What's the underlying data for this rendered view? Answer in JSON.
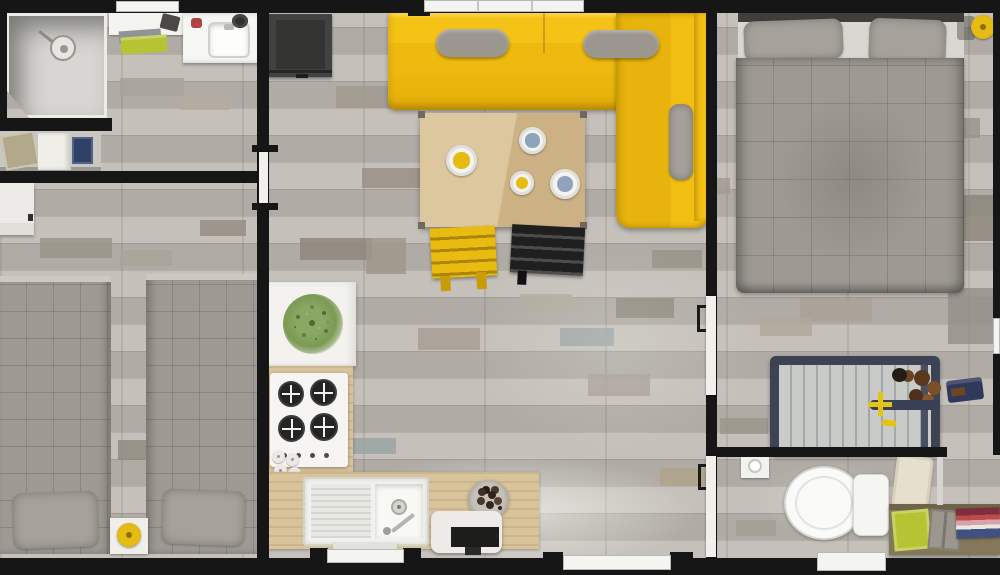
{
  "meta": {
    "kind": "floor-plan-top-down-render",
    "description": "photorealistic top view floor plan of a mobile-home style unit with weathered gray plank flooring"
  },
  "palette": {
    "wall": "#161616",
    "plank_light": "#c5c1ba",
    "plank_dark": "#b0aca5",
    "white_surface": "#f4f4f1",
    "sofa_yellow": "#efbc11",
    "sofa_deep": "#dfa90a",
    "cushion_gray": "#9c978e",
    "table_wood": "#dcc79f",
    "counter_wood": "#d9c39b",
    "chair_yellow": "#e9ba10",
    "chair_black": "#1f1f1f",
    "bed_gray": "#9e9a93",
    "pillow_gray": "#a6a29b",
    "tub_frame": "#3e4353",
    "tub_inner": "#c9cbc9",
    "plant_green": "#7d9a54",
    "towel_green": "#b6c433",
    "towel_navy": "#2f4166",
    "towel_khaki": "#b2a88a",
    "lamp_yellow": "#e6bb12",
    "shelf_wood": "#84785b",
    "fridge_dark": "#424240",
    "accent_red": "#b04343",
    "cup_blue": "#8fa3bb"
  },
  "rooms": {
    "bathroom_top_left": {
      "items": [
        "corner-shower",
        "shower-head",
        "top-window",
        "shelf-with-toiletry-bag",
        "green-floor-towel",
        "vanity-with-sink",
        "towel-rack"
      ],
      "rack_towels": [
        "khaki-towel",
        "white-towel",
        "navy-towel"
      ]
    },
    "bedroom_left": {
      "items": [
        "white-wardrobe",
        "twin-bed-left",
        "twin-bed-right",
        "gray-pillows",
        "nightstand",
        "yellow-lamp"
      ]
    },
    "living_kitchen_center": {
      "items": [
        "tall-dark-cabinet",
        "yellow-corner-sofa",
        "gray-seat-cushions",
        "gray-lumbar-pillow",
        "dining-table",
        "teapot",
        "blue-mugs",
        "yellow-mug",
        "yellow-slat-chair",
        "black-slat-chair",
        "white-plant-table",
        "potted-plant",
        "gas-hob",
        "hob-knobs",
        "salt-pepper-set",
        "l-shaped-counter",
        "sink-with-drainboard",
        "faucet",
        "fruit-bowl",
        "coffee-machine",
        "top-window",
        "bottom-window",
        "patio-window"
      ]
    },
    "bedroom_right": {
      "items": [
        "double-bed",
        "gray-quilted-comforter",
        "gray-pillows",
        "yellow-lamp",
        "bathtub",
        "bath-caddy-baskets",
        "yellow-handle-faucet",
        "clothes-pile"
      ]
    },
    "bathroom_bottom_right": {
      "items": [
        "toilet",
        "toilet-paper-holder",
        "bath-mat",
        "wood-towel-shelf",
        "green-folded-towel",
        "gray-toiletry-bag",
        "stacked-towels",
        "bottom-door"
      ]
    }
  },
  "floor_patches": [
    [
      120,
      78,
      64,
      18,
      "#a8a29a"
    ],
    [
      180,
      96,
      50,
      14,
      "#b4aca0"
    ],
    [
      336,
      86,
      72,
      22,
      "#a19a90"
    ],
    [
      438,
      66,
      54,
      16,
      "#b2a58d"
    ],
    [
      300,
      238,
      72,
      22,
      "#8e867c"
    ],
    [
      362,
      168,
      62,
      20,
      "#999187"
    ],
    [
      520,
      294,
      52,
      18,
      "#b2aa9e"
    ],
    [
      560,
      328,
      54,
      18,
      "#9aa3a4"
    ],
    [
      616,
      298,
      58,
      20,
      "#8f887e"
    ],
    [
      652,
      250,
      50,
      18,
      "#9a9288"
    ],
    [
      688,
      178,
      42,
      16,
      "#a39b90"
    ],
    [
      588,
      374,
      62,
      22,
      "#a8a096"
    ],
    [
      418,
      328,
      62,
      22,
      "#a79f94"
    ],
    [
      350,
      438,
      46,
      16,
      "#9aa3a4"
    ],
    [
      660,
      468,
      52,
      18,
      "#afa28a"
    ],
    [
      800,
      298,
      72,
      24,
      "#a9a196"
    ],
    [
      918,
      118,
      62,
      20,
      "#9a948a"
    ],
    [
      955,
      195,
      45,
      46,
      "#8d877d"
    ],
    [
      760,
      318,
      52,
      18,
      "#b0a89c"
    ],
    [
      720,
      418,
      48,
      16,
      "#9c968c"
    ],
    [
      948,
      288,
      48,
      56,
      "#95908a"
    ],
    [
      40,
      238,
      72,
      20,
      "#9a948a"
    ],
    [
      120,
      250,
      52,
      16,
      "#aaa399"
    ],
    [
      30,
      200,
      40,
      14,
      "#b2aca2"
    ],
    [
      200,
      220,
      46,
      16,
      "#948e84"
    ],
    [
      118,
      440,
      36,
      20,
      "#8f8a80"
    ],
    [
      238,
      300,
      24,
      40,
      "#989288"
    ],
    [
      366,
      238,
      40,
      36,
      "#9f978b"
    ],
    [
      736,
      520,
      40,
      16,
      "#a49e94"
    ],
    [
      870,
      250,
      40,
      30,
      "#8f8a82"
    ]
  ]
}
